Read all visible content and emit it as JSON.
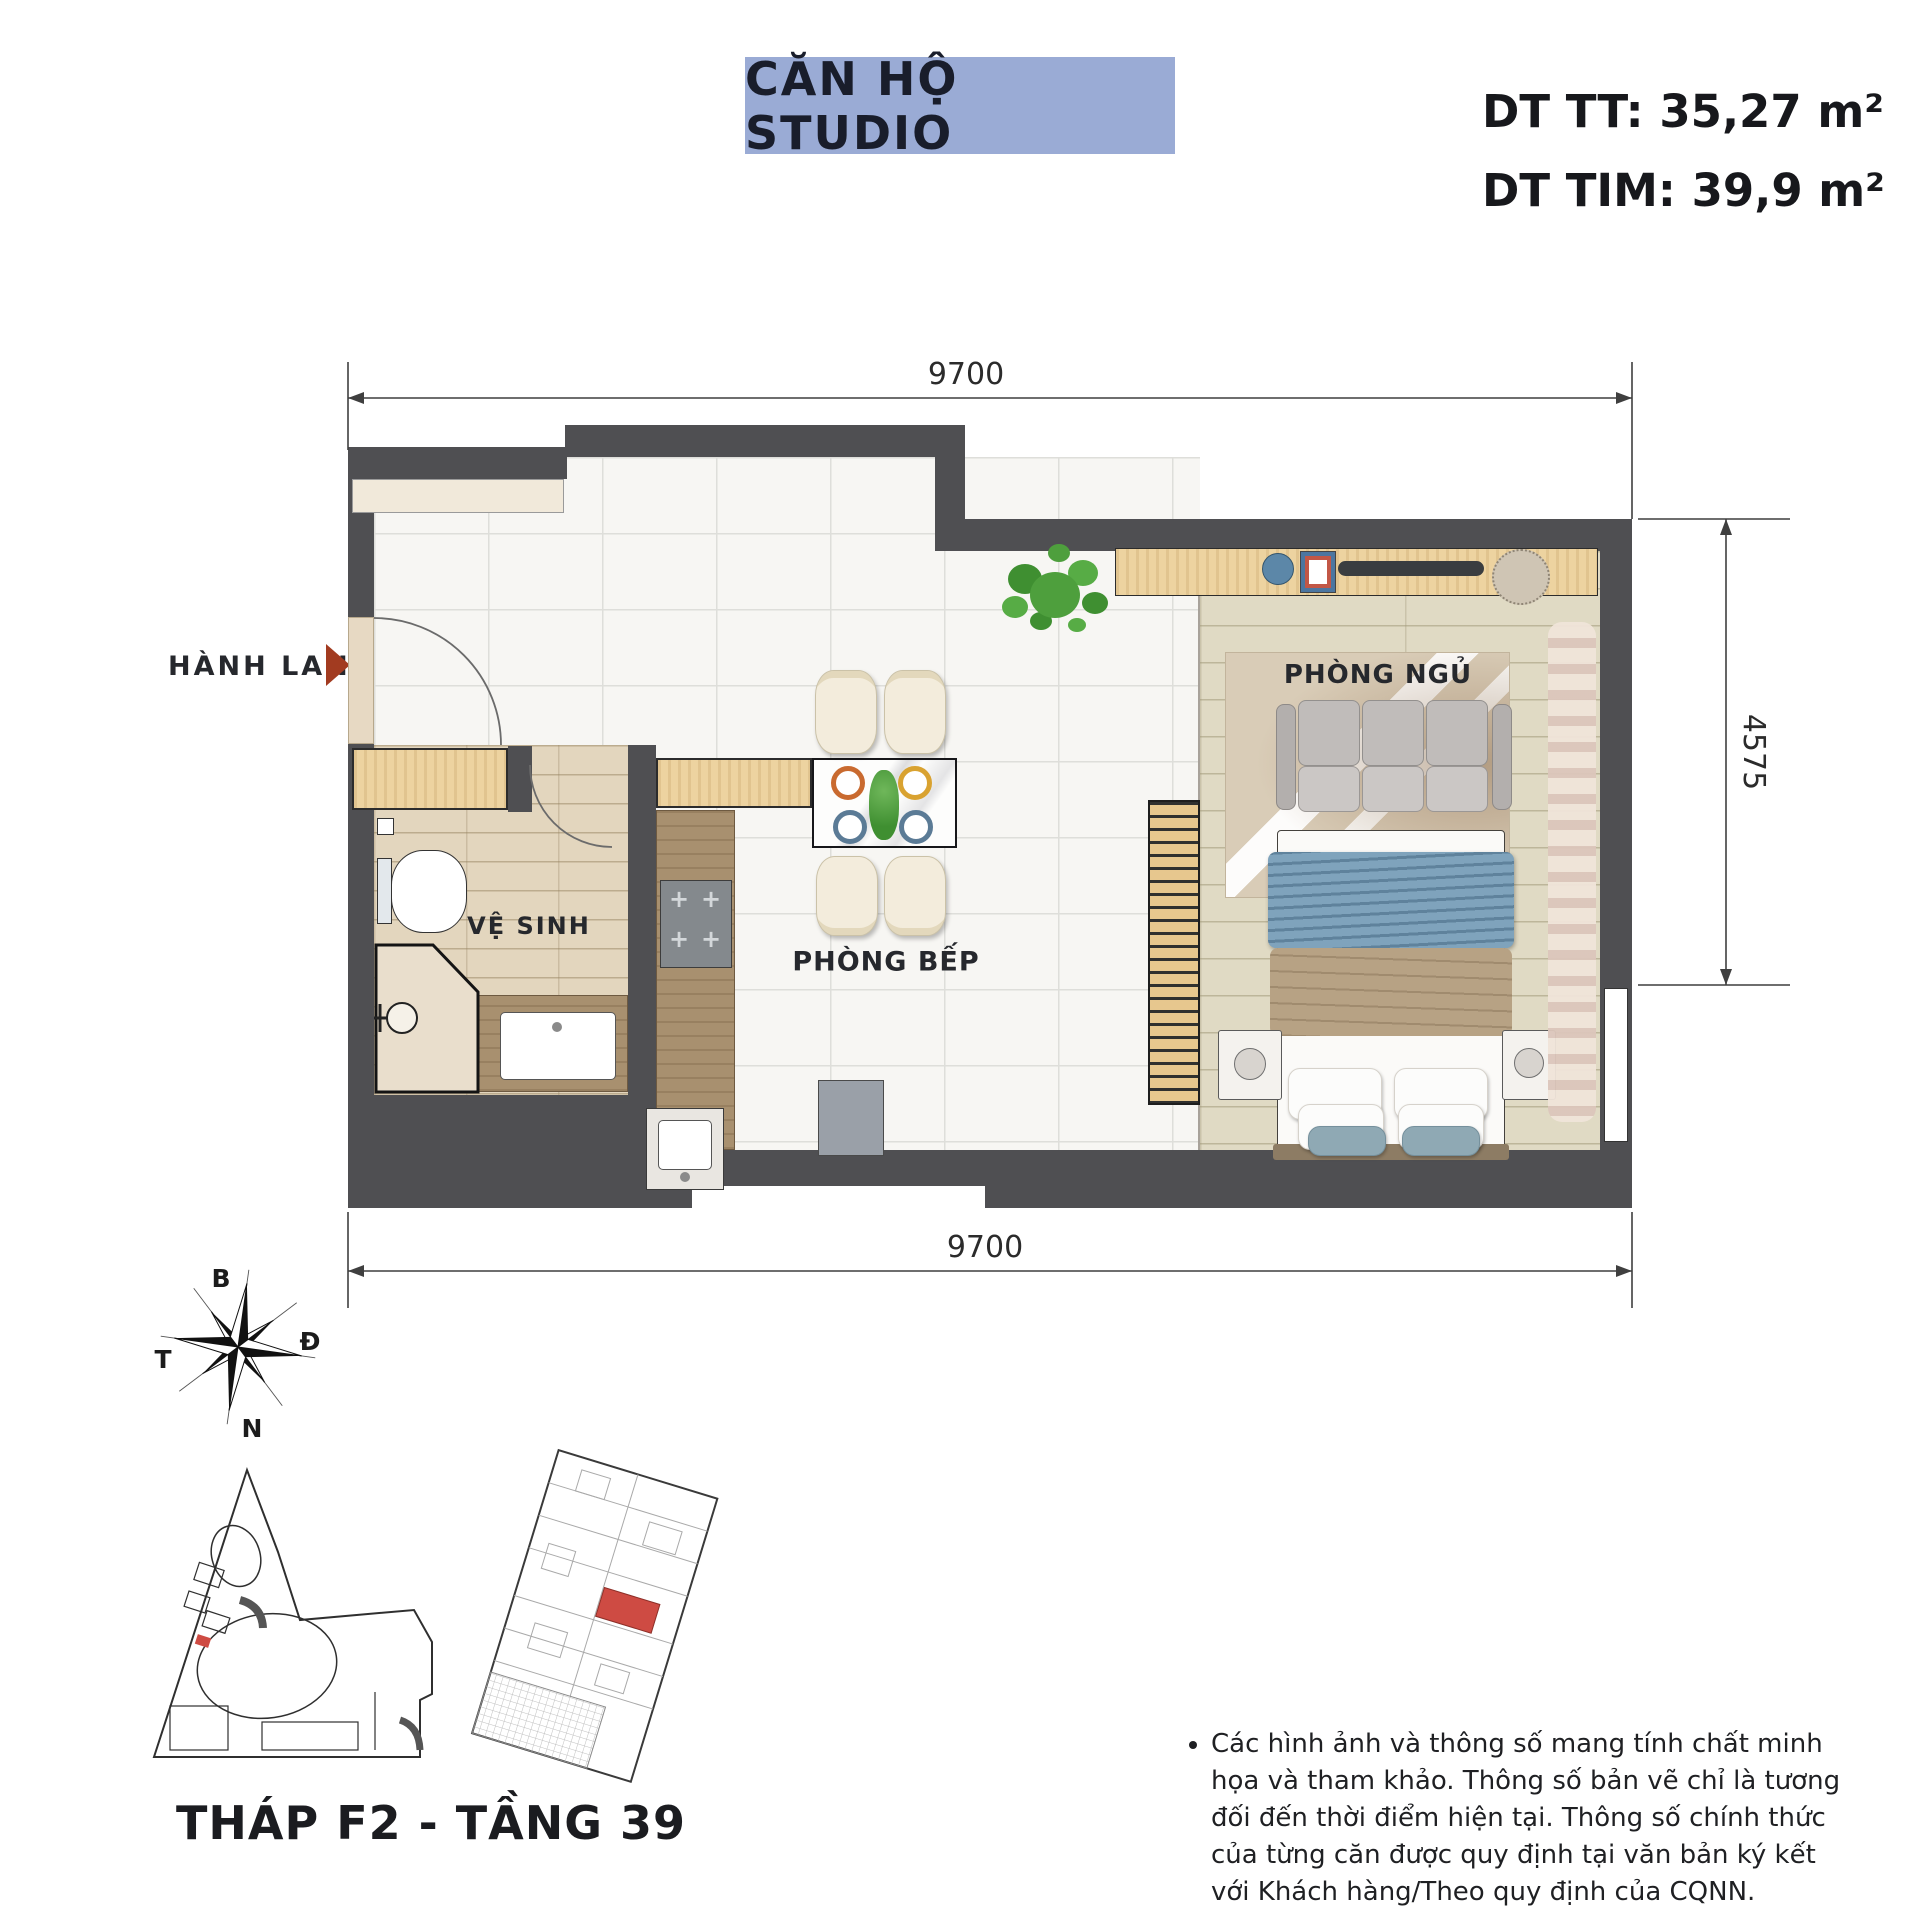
{
  "header": {
    "title": "CĂN HỘ STUDIO",
    "area_tt": "DT TT: 35,27 m²",
    "area_tim": "DT TIM: 39,9 m²"
  },
  "dimensions": {
    "top": "9700",
    "bottom": "9700",
    "right": "4575"
  },
  "rooms": {
    "corridor": "HÀNH LANG",
    "bathroom": "VỆ SINH",
    "kitchen": "PHÒNG BẾP",
    "bedroom": "PHÒNG NGỦ"
  },
  "compass": {
    "north": "B",
    "east": "Đ",
    "south": "N",
    "west": "T"
  },
  "footer": {
    "tower_caption": "THÁP F2 - TẦNG 39",
    "disclaimer": "Các hình ảnh và thông số mang tính chất minh họa và tham khảo. Thông số bản vẽ chỉ là tương đối đến thời điểm hiện tại. Thông số chính thức của từng căn được quy định tại văn bản ký kết với Khách hàng/Theo quy định của CQNN."
  },
  "colors": {
    "banner_bg": "#9AABD5",
    "entrance_arrow": "#A23B20",
    "unit_highlight": "#CE4B43",
    "wall": "#4F4F52",
    "wood": "#EBCF9C",
    "throw_blue": "#7FA3BC"
  },
  "icons": {
    "burner": "+",
    "entrance_arrow": "triangle-right",
    "compass_rose": "star-8"
  }
}
